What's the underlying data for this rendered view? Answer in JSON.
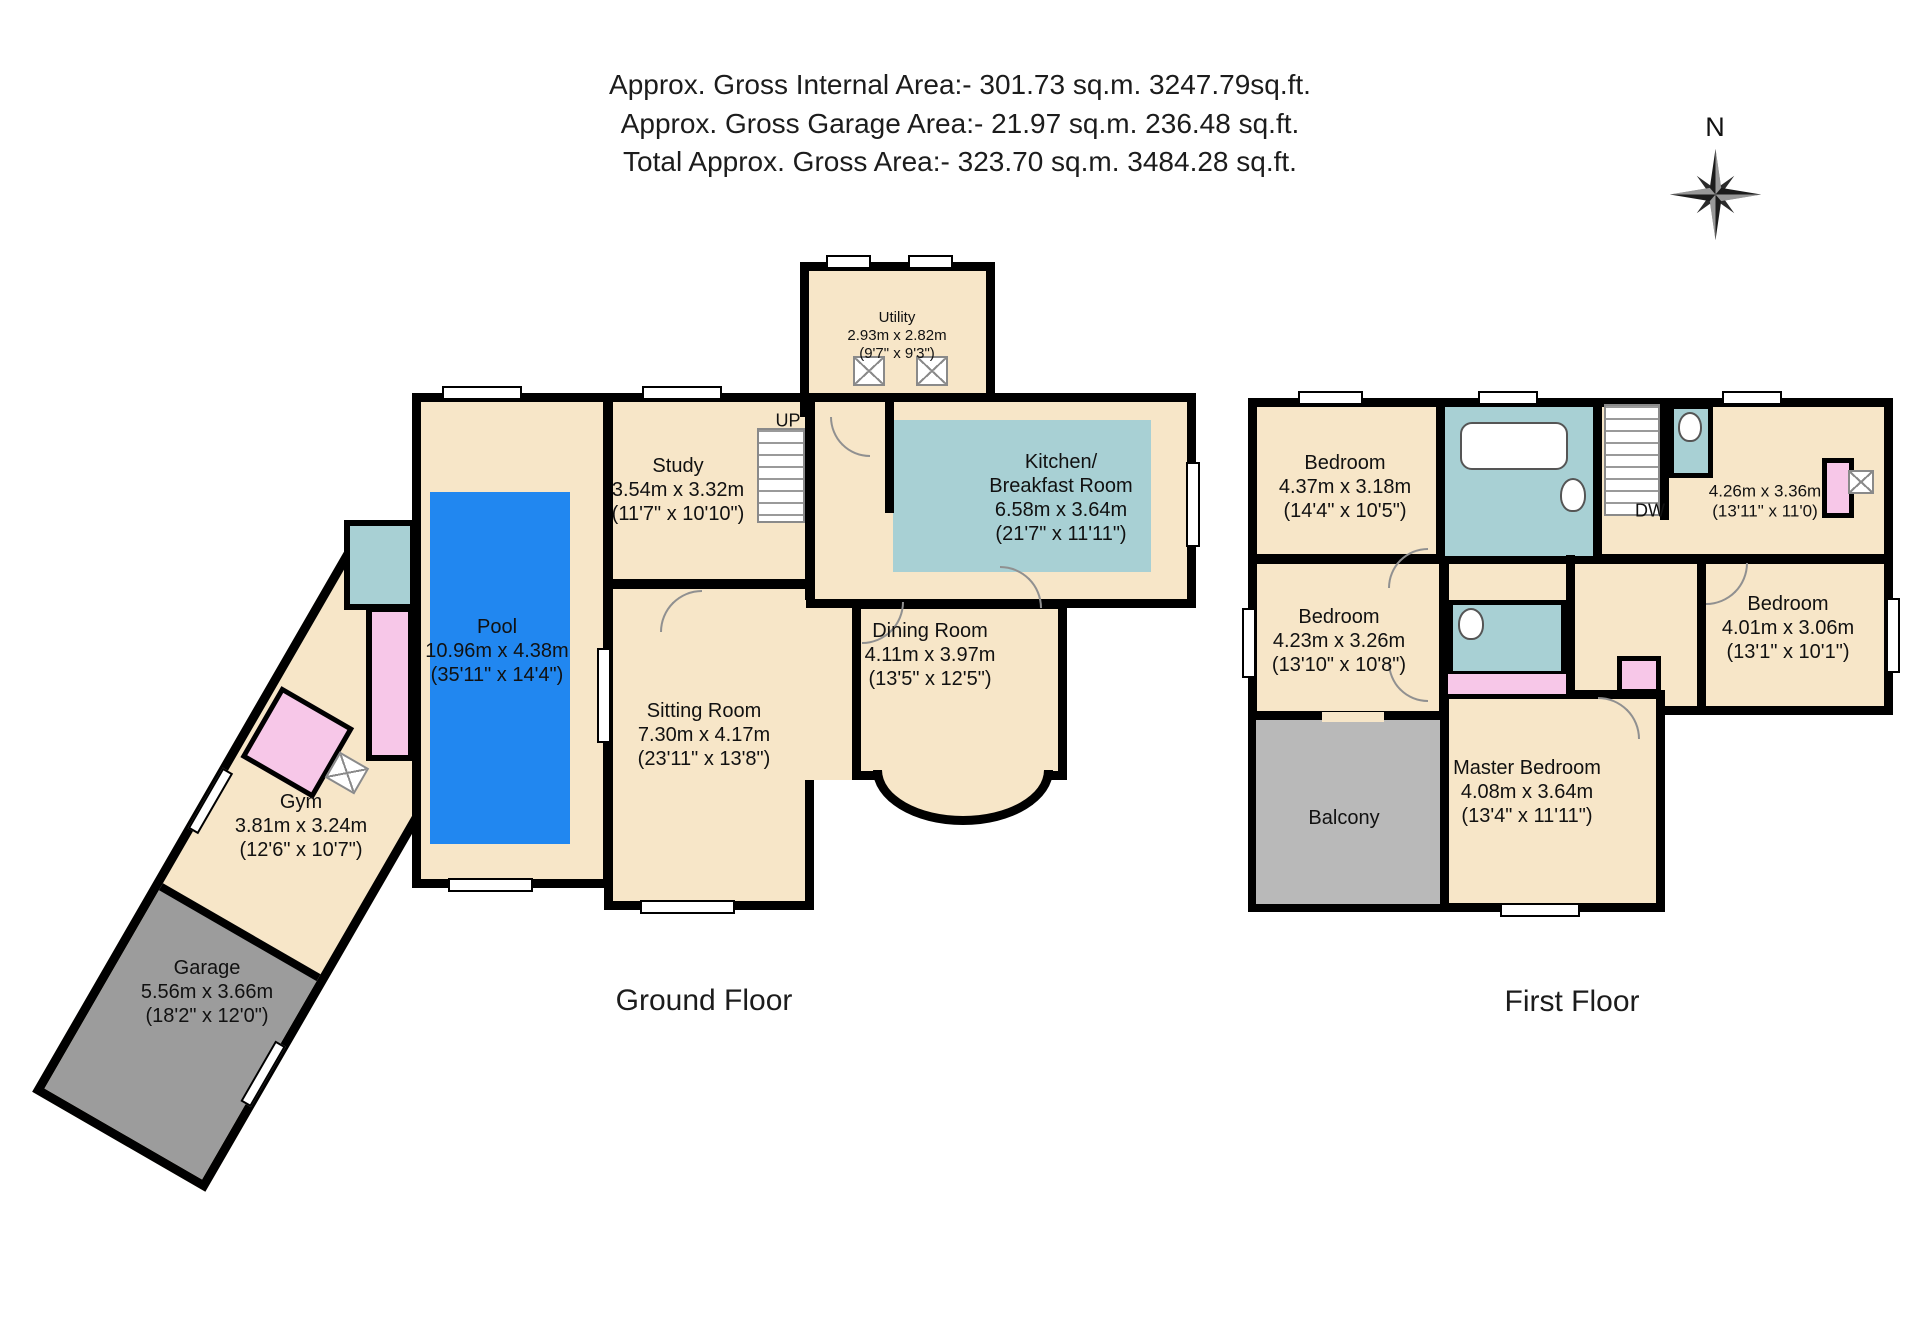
{
  "header": {
    "lines": [
      "Approx. Gross Internal Area:- 301.73 sq.m. 3247.79sq.ft.",
      "Approx. Gross Garage Area:- 21.97 sq.m. 236.48 sq.ft.",
      "Total Approx. Gross Area:- 323.70 sq.m. 3484.28 sq.ft."
    ]
  },
  "compass": {
    "north": "N"
  },
  "ground_floor": {
    "label": "Ground Floor",
    "stairs_label": "UP",
    "rooms": {
      "pool": {
        "name": "Pool",
        "dims_m": "10.96m x 4.38m",
        "dims_ft": "(35'11\" x 14'4\")"
      },
      "study": {
        "name": "Study",
        "dims_m": "3.54m x 3.32m",
        "dims_ft": "(11'7\" x 10'10\")"
      },
      "utility": {
        "name": "Utility",
        "dims_m": "2.93m x 2.82m",
        "dims_ft": "(9'7\" x 9'3\")"
      },
      "kitchen": {
        "name_line1": "Kitchen/",
        "name_line2": "Breakfast Room",
        "dims_m": "6.58m x 3.64m",
        "dims_ft": "(21'7\" x 11'11\")"
      },
      "dining": {
        "name": "Dining Room",
        "dims_m": "4.11m x 3.97m",
        "dims_ft": "(13'5\" x 12'5\")"
      },
      "sitting": {
        "name": "Sitting Room",
        "dims_m": "7.30m x 4.17m",
        "dims_ft": "(23'11\" x 13'8\")"
      },
      "gym": {
        "name": "Gym",
        "dims_m": "3.81m x 3.24m",
        "dims_ft": "(12'6\" x 10'7\")"
      },
      "garage": {
        "name": "Garage",
        "dims_m": "5.56m x 3.66m",
        "dims_ft": "(18'2\" x 12'0\")"
      }
    }
  },
  "first_floor": {
    "label": "First Floor",
    "dw_label": "DW",
    "rooms": {
      "bedroom_front": {
        "name": "Bedroom",
        "dims_m": "4.37m x 3.18m",
        "dims_ft": "(14'4\" x 10'5\")"
      },
      "room_top_right": {
        "dims_m": "4.26m x 3.36m",
        "dims_ft": "(13'11\" x 11'0)"
      },
      "bedroom_mid": {
        "name": "Bedroom",
        "dims_m": "4.23m x 3.26m",
        "dims_ft": "(13'10\" x 10'8\")"
      },
      "bedroom_rear_right": {
        "name": "Bedroom",
        "dims_m": "4.01m x 3.06m",
        "dims_ft": "(13'1\" x 10'1\")"
      },
      "master": {
        "name": "Master Bedroom",
        "dims_m": "4.08m x 3.64m",
        "dims_ft": "(13'4\" x 11'11\")"
      },
      "balcony": {
        "name": "Balcony"
      }
    }
  },
  "colors": {
    "room_fill": "#f7e6c8",
    "wet_room_fill": "#a8d0d4",
    "pool_fill": "#2187f0",
    "closet_fill": "#f7c7e8",
    "garage_fill": "#9c9c9c",
    "balcony_fill": "#b9b9b9",
    "wall": "#000000"
  }
}
